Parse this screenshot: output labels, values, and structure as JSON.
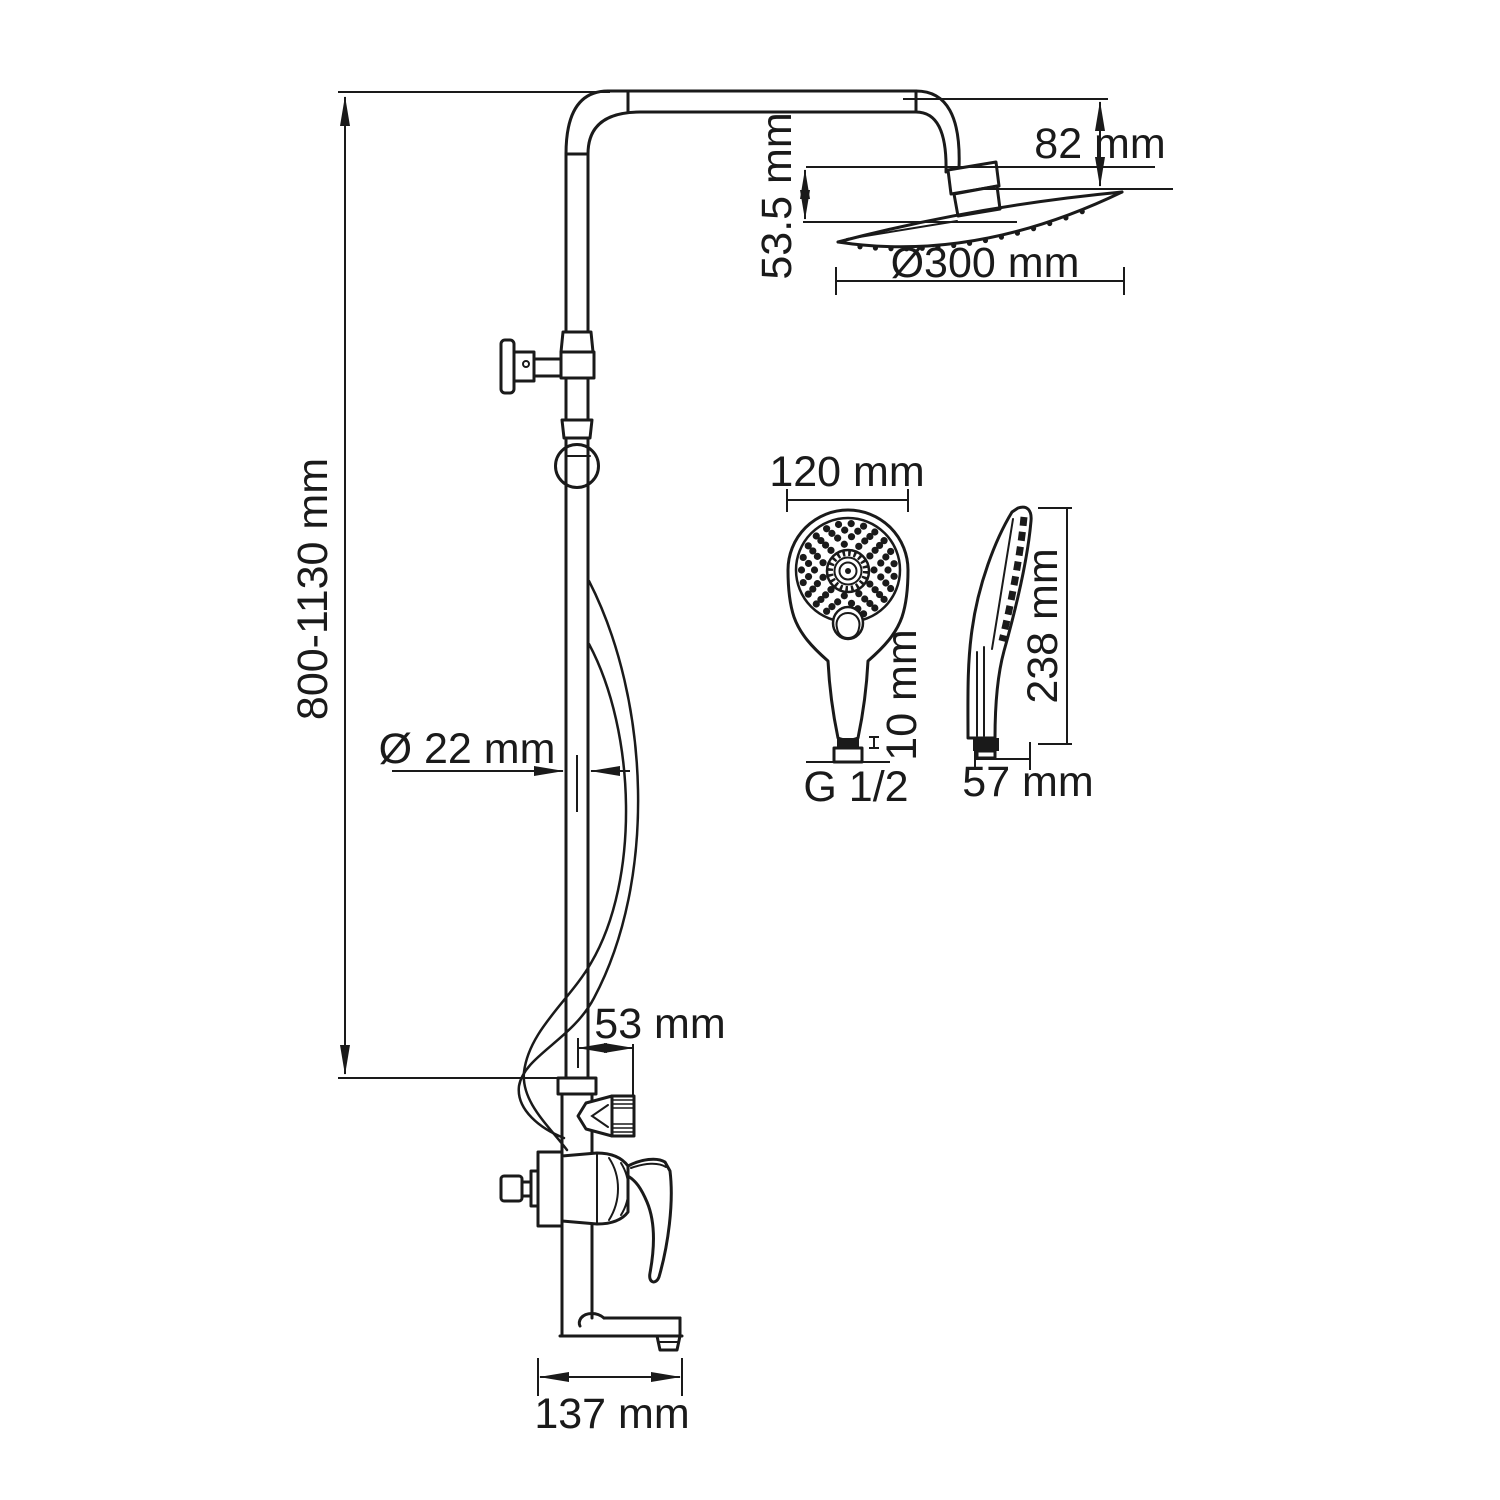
{
  "labels": {
    "overall_height": "800-1130 mm",
    "head_drop": "82 mm",
    "head_offset": "53.5 mm",
    "head_diameter": "Ø300 mm",
    "pipe_diameter": "Ø 22 mm",
    "outlet_offset": "53 mm",
    "spout_length": "137 mm",
    "hand_shower_width": "120 mm",
    "connection_thread": "G 1/2",
    "thread_length": "10 mm",
    "hand_shower_length": "238 mm",
    "hand_shower_depth": "57 mm"
  },
  "colors": {
    "line": "#1a1a1a",
    "background": "#ffffff"
  }
}
